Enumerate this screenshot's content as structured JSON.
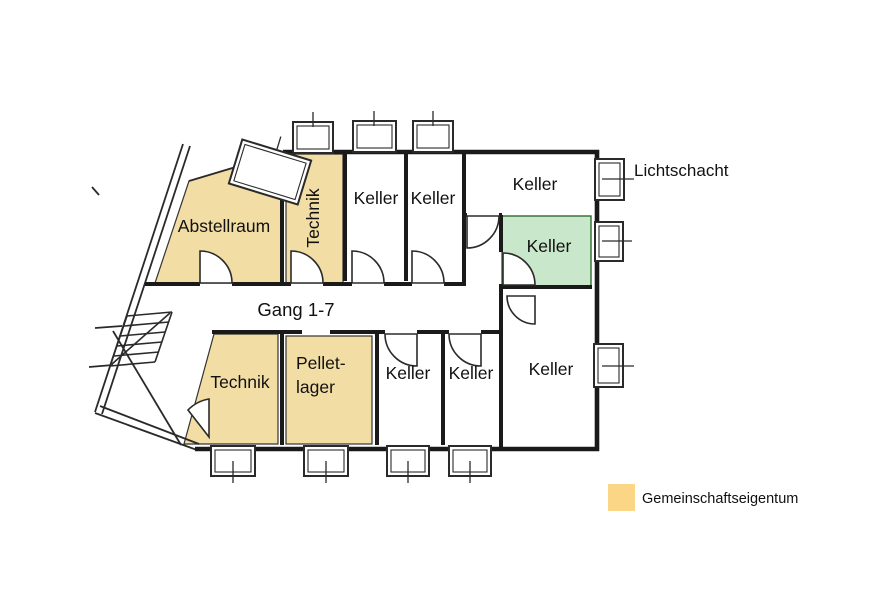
{
  "plan": {
    "rooms": {
      "abstellraum": {
        "label": "Abstellraum"
      },
      "technik_top": {
        "label": "Technik"
      },
      "keller_top_1": {
        "label": "Keller"
      },
      "keller_top_2": {
        "label": "Keller"
      },
      "keller_top_large": {
        "label": "Keller"
      },
      "keller_highlighted": {
        "label": "Keller"
      },
      "technik_bottom": {
        "label": "Technik"
      },
      "pelletlager": {
        "label_line1": "Pellet-",
        "label_line2": "lager"
      },
      "keller_bottom_1": {
        "label": "Keller"
      },
      "keller_bottom_2": {
        "label": "Keller"
      },
      "keller_bottom_large": {
        "label": "Keller"
      }
    },
    "corridor": {
      "label": "Gang 1-7"
    },
    "annotation": {
      "lichtschacht": "Lichtschacht"
    }
  },
  "legend": {
    "label": "Gemeinschaftseigentum",
    "swatch_color": "#FBD687"
  },
  "colors": {
    "common_area": "#F2DEA4",
    "highlight": "#C9E7CA",
    "wall": "#1a1a1a",
    "background": "#ffffff"
  }
}
